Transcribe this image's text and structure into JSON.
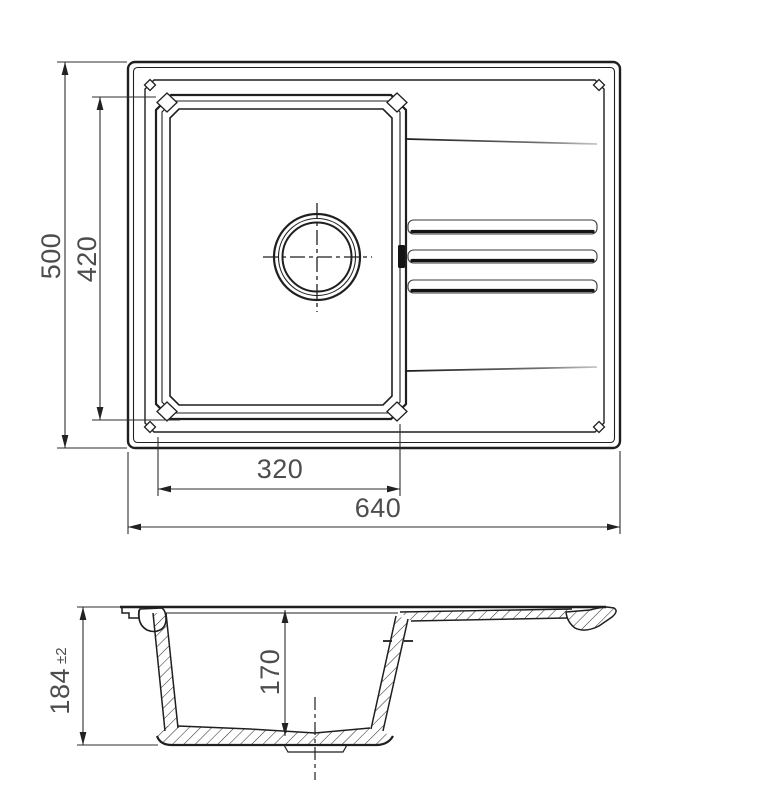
{
  "colors": {
    "line": "#1f1f1f",
    "dimension_text": "#4d4d4d",
    "background": "#ffffff"
  },
  "top_view": {
    "dim_overall_width": "640",
    "dim_overall_depth": "500",
    "dim_bowl_width": "320",
    "dim_bowl_depth": "420"
  },
  "side_view": {
    "dim_height": "184",
    "dim_height_tolerance": "±2",
    "dim_bowl_inner_depth": "170"
  }
}
